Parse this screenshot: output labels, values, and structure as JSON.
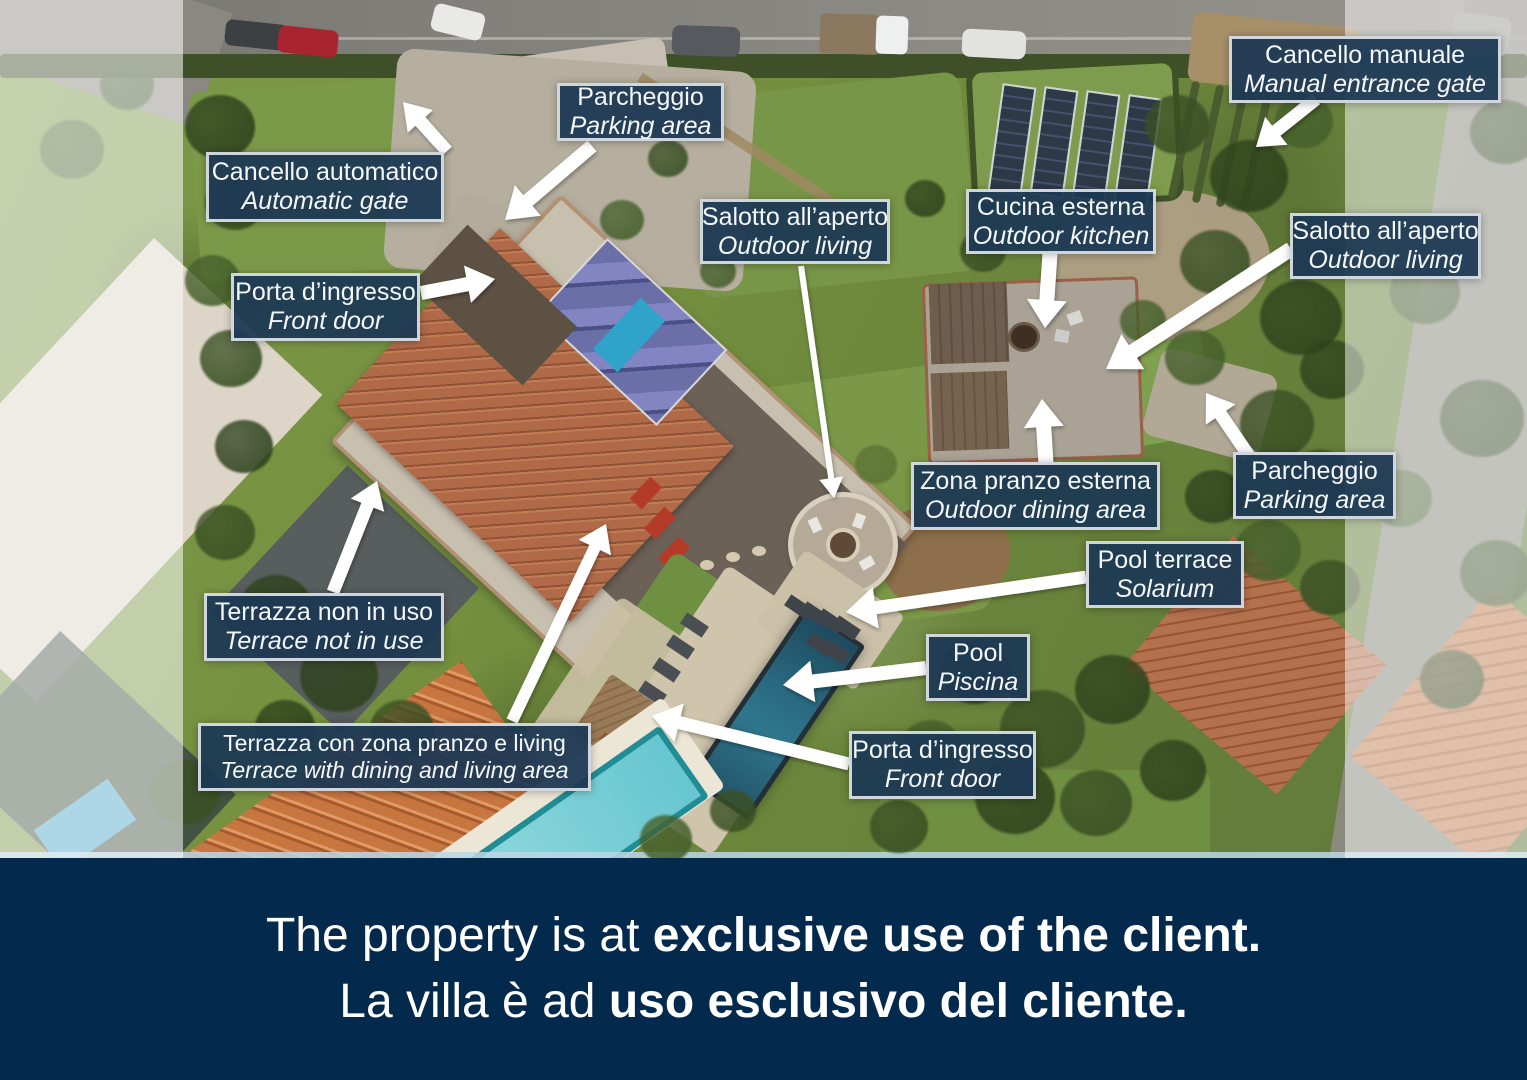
{
  "colors": {
    "label_bg": "#1d3854",
    "label_border": "#eef1f4",
    "label_text": "#f4f7f9",
    "footer_bg": "#03294d",
    "footer_text": "#ffffff",
    "arrow": "#ffffff"
  },
  "annotations": [
    {
      "id": "parking-top",
      "line1": "Parcheggio",
      "line2": "Parking area"
    },
    {
      "id": "manual-gate",
      "line1": "Cancello manuale",
      "line2": "Manual entrance gate"
    },
    {
      "id": "automatic-gate",
      "line1": "Cancello automatico",
      "line2": "Automatic gate"
    },
    {
      "id": "front-door-house",
      "line1": "Porta d’ingresso",
      "line2": "Front door"
    },
    {
      "id": "outdoor-living-left",
      "line1": "Salotto all’aperto",
      "line2": "Outdoor living"
    },
    {
      "id": "outdoor-kitchen",
      "line1": "Cucina esterna",
      "line2": "Outdoor kitchen"
    },
    {
      "id": "outdoor-living-right",
      "line1": "Salotto all’aperto",
      "line2": "Outdoor living"
    },
    {
      "id": "outdoor-dining",
      "line1": "Zona pranzo esterna",
      "line2": "Outdoor dining area"
    },
    {
      "id": "parking-right",
      "line1": "Parcheggio",
      "line2": "Parking area"
    },
    {
      "id": "pool-terrace",
      "line1": "Pool terrace",
      "line2": "Solarium"
    },
    {
      "id": "pool",
      "line1": "Pool",
      "line2": "Piscina"
    },
    {
      "id": "terrace-not-in-use",
      "line1": "Terrazza non in uso",
      "line2": "Terrace not in use"
    },
    {
      "id": "terrace-dining",
      "line1": "Terrazza con zona pranzo e living",
      "line2": "Terrace with dining and living area"
    },
    {
      "id": "front-door-pool",
      "line1": "Porta d’ingresso",
      "line2": "Front door"
    }
  ],
  "footer": {
    "line1_regular": "The property is at ",
    "line1_bold": "exclusive use of the client.",
    "line2_regular": "La villa è ad ",
    "line2_bold": "uso esclusivo del cliente."
  }
}
